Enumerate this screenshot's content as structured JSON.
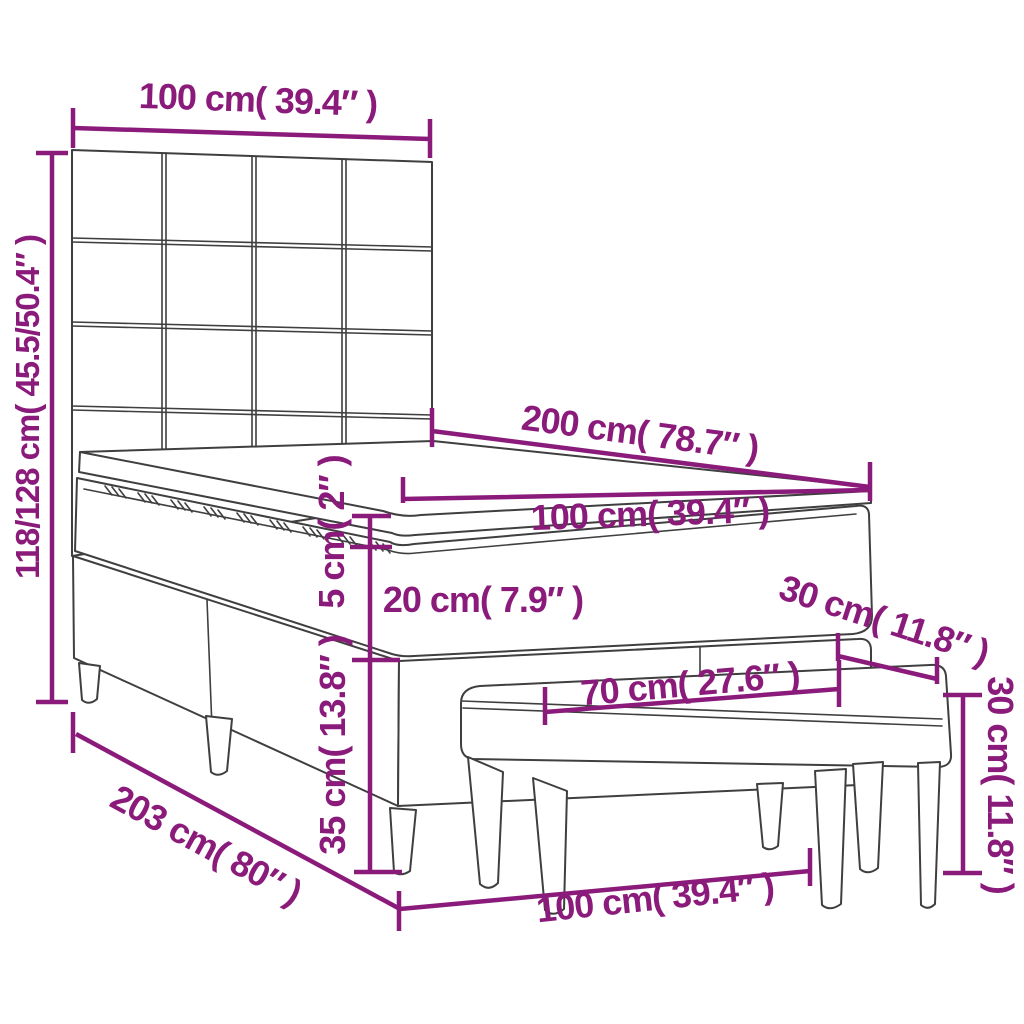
{
  "diagram": {
    "kind": "furniture-dimension-diagram",
    "colors": {
      "accent": "#8B1B7B",
      "line_art": "#3F3F3F",
      "background": "#FFFFFF"
    },
    "labels": {
      "headboard_width": "100 cm( 39.4″ )",
      "overall_height": "118/128 cm( 45.5/50.4″ )",
      "bed_length": "200 cm( 78.7″ )",
      "mattress_width": "100 cm( 39.4″ )",
      "topper_height": "5 cm( 2″ )",
      "mattress_height": "20 cm( 7.9″ )",
      "bench_depth": "30 cm( 11.8″ )",
      "bench_length": "70 cm( 27.6″ )",
      "bench_height": "30 cm( 11.8″ )",
      "base_height": "35 cm( 13.8″ )",
      "frame_length": "203 cm( 80″ )",
      "bed_width": "100 cm( 39.4″ )"
    }
  }
}
